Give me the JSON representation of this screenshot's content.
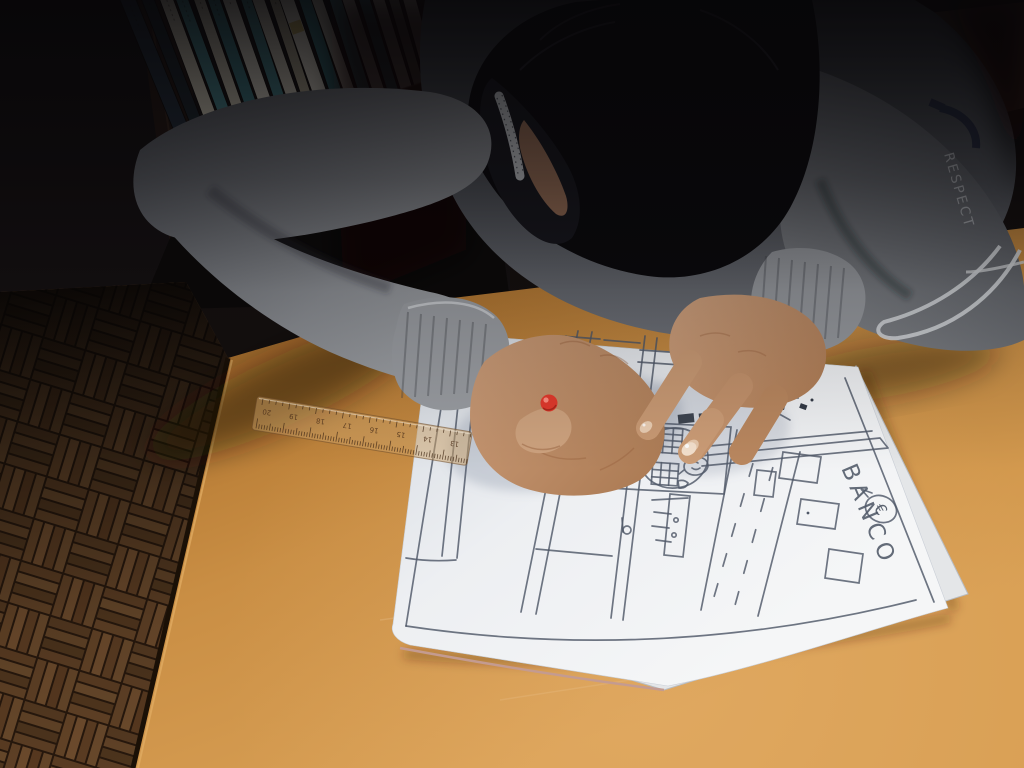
{
  "scene": {
    "description": "A child in a gray melange sweater and black face mask leans over an orange wooden school desk, drawing a street map of a town in pencil on a white sheet. A transparent ruler and a red-tipped pen rest on the paper; behind is a parquet floor and a bookshelf.",
    "setting": "classroom with parquet floor and bookshelf"
  },
  "drawing": {
    "bank_sign": "BANCO",
    "currency_symbol": "€",
    "features": [
      "city blocks",
      "street with dashed lane markings",
      "round plaza with brick structures",
      "building facade with windows",
      "bench",
      "margin border"
    ]
  },
  "sleeve": {
    "print_text": "RESPECT"
  },
  "ruler": {
    "numbers": [
      "20",
      "19",
      "18",
      "17",
      "16",
      "15",
      "14",
      "13"
    ],
    "tint": "#c89a5e"
  },
  "pen": {
    "tip_color": "#e23a2c",
    "body_color": "#37303a",
    "collar_color": "#ddd9d4"
  },
  "bookshelf": {
    "books": [
      {
        "c": "#232e3a",
        "w": 15,
        "h": 185,
        "l": -3
      },
      {
        "c": "#1d272e",
        "w": 12,
        "h": 196,
        "l": -2
      },
      {
        "c": "#d6d0bd",
        "w": 13,
        "h": 178,
        "l": -1
      },
      {
        "c": "#4a8a91",
        "w": 12,
        "h": 172,
        "l": -1
      },
      {
        "c": "#cfc9b6",
        "w": 11,
        "h": 180,
        "l": 0
      },
      {
        "c": "#3f7d85",
        "w": 12,
        "h": 168,
        "l": 0
      },
      {
        "c": "#e1ddcf",
        "w": 13,
        "h": 175,
        "l": 0
      },
      {
        "c": "#47858c",
        "w": 11,
        "h": 165,
        "l": 1
      },
      {
        "c": "#d5cfbf",
        "w": 12,
        "h": 172,
        "l": 0
      },
      {
        "c": "#b2aa92",
        "w": 10,
        "h": 160,
        "l": 1
      },
      {
        "c": "#e4dfd1",
        "w": 14,
        "h": 170,
        "l": 0,
        "band": "#c9b469"
      },
      {
        "c": "#3a7880",
        "w": 12,
        "h": 162,
        "l": 1
      },
      {
        "c": "#d8d3c3",
        "w": 11,
        "h": 168,
        "l": 0
      },
      {
        "c": "#49878e",
        "w": 12,
        "h": 158,
        "l": 2
      },
      {
        "c": "#dcd7c8",
        "w": 12,
        "h": 165,
        "l": 1
      },
      {
        "c": "#3d7b83",
        "w": 11,
        "h": 155,
        "l": 2
      },
      {
        "c": "#d2ccbc",
        "w": 12,
        "h": 160,
        "l": 2
      },
      {
        "c": "#8a8d7c",
        "w": 10,
        "h": 150,
        "l": 3
      },
      {
        "c": "#c7c0b0",
        "w": 13,
        "h": 156,
        "l": 4
      }
    ]
  },
  "palette": {
    "desk": "#c9873f",
    "desk_bright": "#d9a055",
    "paper": "#eef0f3",
    "pencil_line": "#4f5868",
    "sweater": "#7e8186",
    "hair": "#0a090c",
    "mask": "#17171d",
    "skin": "#c6926c",
    "parquet": "#6e4b2b",
    "floor_dark": "#2a1a0e"
  }
}
